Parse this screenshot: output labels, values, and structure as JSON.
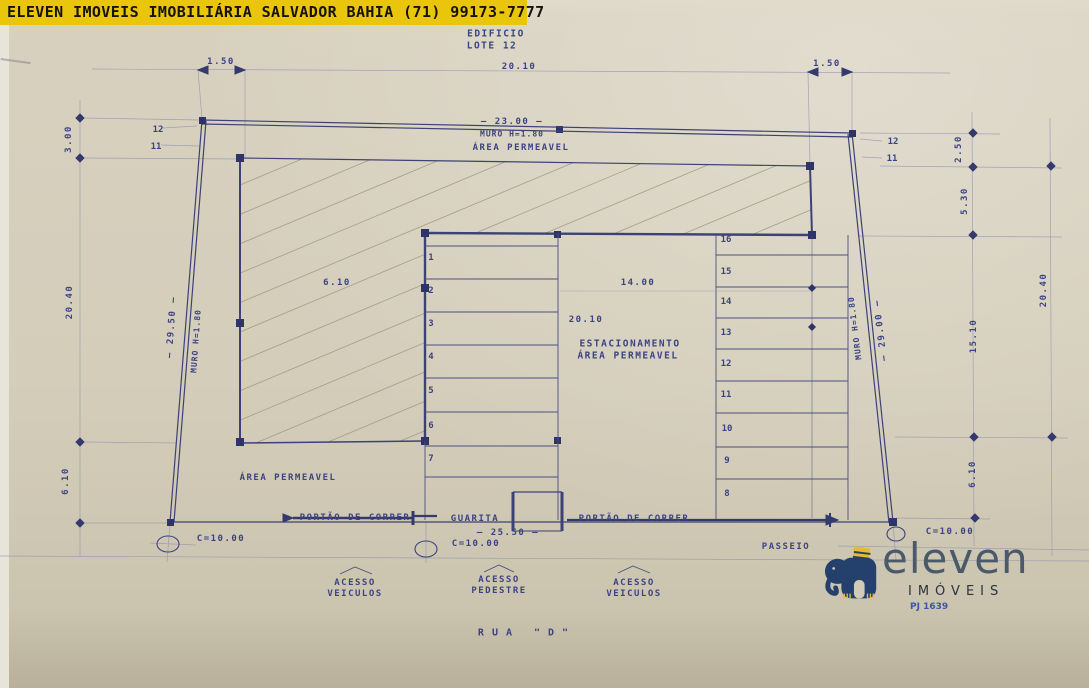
{
  "banner": {
    "text": "ELEVEN IMOVEIS IMOBILIÁRIA SALVADOR BAHIA (71) 99173-7777"
  },
  "plan": {
    "site_title": {
      "line1": "EDIFICIO",
      "line2": "LOTE 12"
    },
    "street": "RUA  \"D\"",
    "labels": {
      "muro_top": "MURO H=1.80",
      "muro_left": "MURO H=1.80",
      "muro_right": "MURO H=1.80",
      "area_permeavel_top": "ÁREA PERMEAVEL",
      "area_permeavel_bottom": "ÁREA PERMEAVEL",
      "estacionamento_line1": "ESTACIONAMENTO",
      "estacionamento_line2": "ÁREA PERMEAVEL",
      "portao_left": "PORTÃO DE CORRER",
      "portao_right": "PORTÃO DE CORRER",
      "guarita": "GUARITA",
      "passeio": "PASSEIO"
    },
    "dimensions": {
      "top_left_setback": "1.50",
      "top_width": "20.10",
      "top_right_setback": "1.50",
      "front_wall": "— 23.00 —",
      "left_top": "3.00",
      "left_height": "20.40",
      "left_wall": "— 29.50 —",
      "left_bottom": "6.10",
      "right_top": "2.50",
      "right_upper": "5.30",
      "right_mid": "15.10",
      "right_height": "20.40",
      "right_bottom": "6.10",
      "right_wall": "— 29.00 —",
      "building_width": "6.10",
      "parking_width": "14.00",
      "parking_depth": "20.10",
      "gate_span": "— 25.50 —",
      "curb_left": "C=10.00",
      "curb_center": "C=10.00",
      "curb_right": "C=10.00"
    },
    "stalls_left": [
      "1",
      "2",
      "3",
      "4",
      "5",
      "6",
      "7"
    ],
    "stalls_right": [
      "16",
      "15",
      "14",
      "13",
      "12",
      "11",
      "10",
      "9",
      "8"
    ],
    "wall_markers_left": [
      "12",
      "11"
    ],
    "wall_markers_right": [
      "12",
      "11"
    ],
    "access": [
      {
        "line1": "ACESSO",
        "line2": "VEICULOS"
      },
      {
        "line1": "ACESSO",
        "line2": "PEDESTRE"
      },
      {
        "line1": "ACESSO",
        "line2": "VEICULOS"
      }
    ]
  },
  "logo": {
    "brand": "eleven",
    "subtitle": "IMÓVEIS",
    "registration": "PJ 1639"
  },
  "colors": {
    "banner_bg": "#e9c50b",
    "ink": "#3c4382",
    "paper": "#d3ccb9",
    "logo_navy": "#24416e",
    "logo_yellow": "#e4bc2f"
  }
}
